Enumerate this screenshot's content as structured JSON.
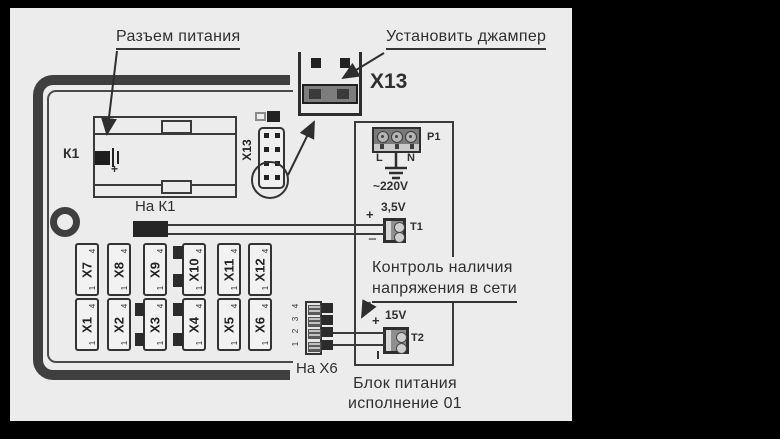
{
  "labels": {
    "power_connector": "Разъем питания",
    "install_jumper": "Установить джампер",
    "x13_big": "X13",
    "monitor_line1": "Контроль наличия",
    "monitor_line2": "напряжения в сети",
    "psu_caption_line1": "Блок питания",
    "psu_caption_line2": "исполнение 01",
    "na_k1": "На К1",
    "na_x6": "На Х6",
    "k1": "К1"
  },
  "board": {
    "x13_connector_label": "Х13",
    "connectors_top": [
      "X7",
      "X8",
      "X9",
      "X10",
      "X11",
      "X12"
    ],
    "connectors_bottom": [
      "X1",
      "X2",
      "X3",
      "X4",
      "X5",
      "X6"
    ],
    "pin_top": "4",
    "pin_bottom": "1",
    "x6_header_pins": [
      "4",
      "3",
      "2",
      "1"
    ]
  },
  "psu": {
    "p1_label": "P1",
    "line_l": "L",
    "line_n": "N",
    "mains_voltage": "~220V",
    "t1_label": "T1",
    "t1_voltage": "3,5V",
    "t1_plus": "+",
    "t1_minus": "−",
    "t2_label": "T2",
    "t2_voltage": "15V",
    "t2_plus": "+"
  },
  "colors": {
    "panel": "#ececec",
    "ink": "#3f3f3f",
    "text": "#2f2f2f",
    "component_dark": "#2b2b2b",
    "jumper_gray": "#7d7d7d"
  }
}
